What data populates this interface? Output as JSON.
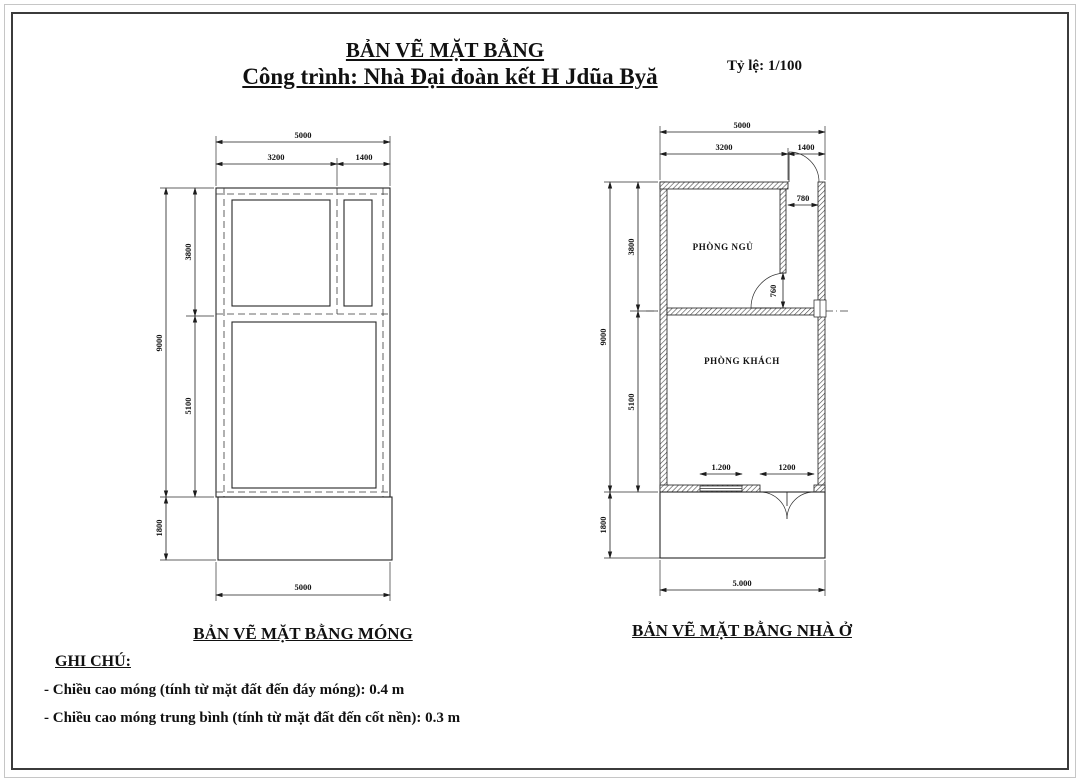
{
  "page": {
    "title": "BẢN VẼ MẶT BẰNG",
    "subtitle": "Công trình: Nhà Đại đoàn kết H Jdũa Byă",
    "scale": "Tỷ lệ: 1/100"
  },
  "foundation_plan": {
    "caption": "BẢN VẼ MẶT BẰNG MÓNG",
    "dims": {
      "overall_width": "5000",
      "bay_left": "3200",
      "bay_right": "1400",
      "overall_height": "9000",
      "section_top": "3800",
      "section_bottom": "5100",
      "porch_depth": "1800",
      "overall_width_bottom": "5000"
    }
  },
  "house_plan": {
    "caption": "BẢN VẼ MẶT BẰNG NHÀ Ở",
    "rooms": {
      "bedroom": "PHÒNG NGỦ",
      "living": "PHÒNG KHÁCH"
    },
    "dims": {
      "overall_width": "5000",
      "bay_left": "3200",
      "bay_right": "1400",
      "overall_height": "9000",
      "section_top": "3800",
      "section_bottom": "5100",
      "porch_depth": "1800",
      "entry_door_width": "780",
      "bedroom_door_width": "760",
      "window_width": "1.200",
      "main_door_width": "1200",
      "overall_width_bottom": "5.000"
    }
  },
  "notes": {
    "heading": "GHI CHÚ:",
    "items": [
      "- Chiều cao móng (tính từ mặt đất đến đáy móng): 0.4 m",
      "- Chiều cao móng trung bình (tính từ mặt đất đến cốt nền): 0.3 m"
    ]
  },
  "colors": {
    "line": "#1c1c1c",
    "paper": "#ffffff"
  }
}
